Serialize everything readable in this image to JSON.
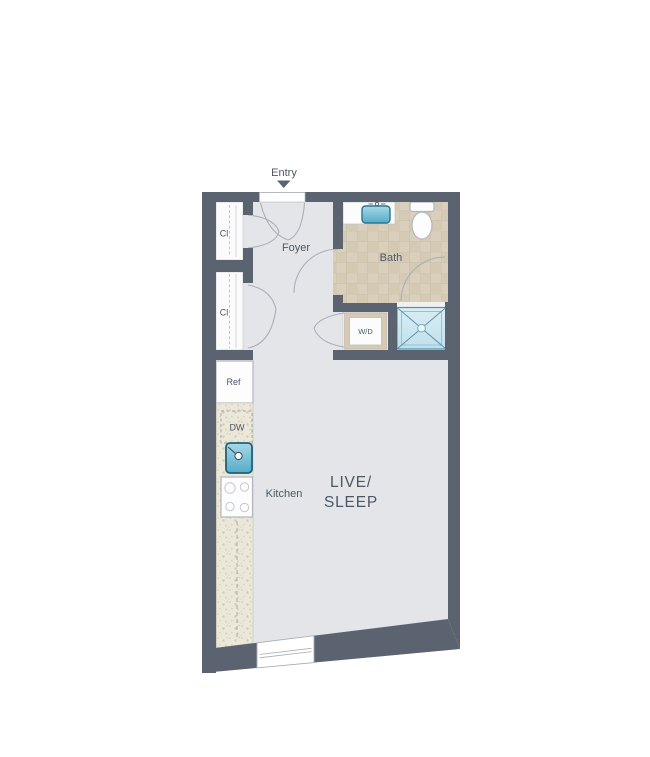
{
  "floorplan": {
    "entry": {
      "label": "Entry"
    },
    "rooms": {
      "foyer": "Foyer",
      "bath": "Bath",
      "closet_top": "Cl",
      "closet_bottom": "Cl",
      "kitchen": "Kitchen",
      "live_sleep_line1": "LIVE/",
      "live_sleep_line2": "SLEEP"
    },
    "appliances": {
      "washer_dryer": "W/D",
      "refrigerator": "Ref",
      "dishwasher": "DW"
    },
    "colors": {
      "wall": "#5b6370",
      "floor": "#e4e5e8",
      "closet_floor": "#fbfbfb",
      "bath_tile": "#d9cfbc",
      "counter": "#ece8da",
      "sink_blue": "#5cb0ca",
      "shower_blue": "#c0e1ed",
      "door_arc": "#a9b0b8",
      "label_text": "#4d5763"
    }
  }
}
